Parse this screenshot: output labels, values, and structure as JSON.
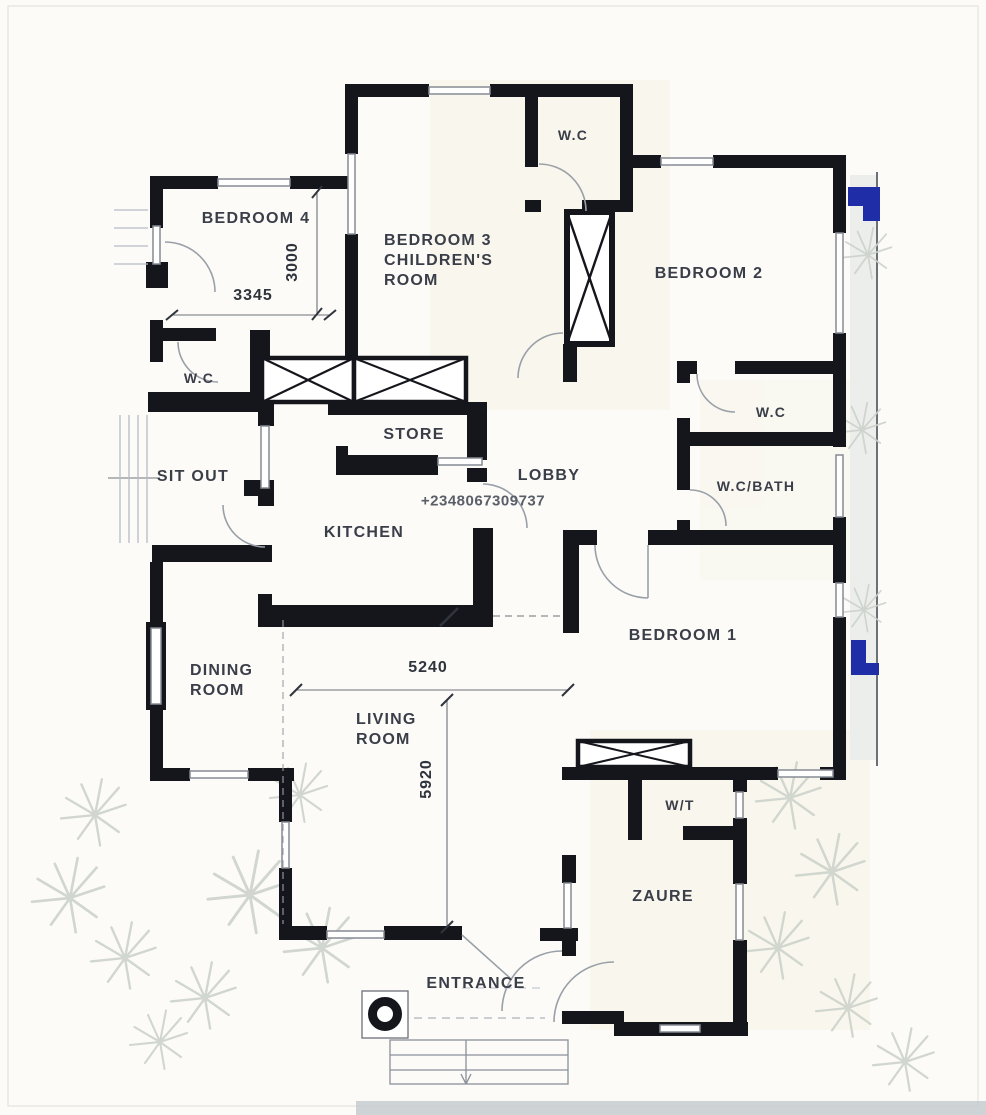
{
  "document": {
    "type": "residential-floor-plan",
    "background_color": "#fcfbf8"
  },
  "colors": {
    "wall": "#15151c",
    "thin_line": "#8a909a",
    "light_line": "#b6bcc4",
    "text": "#3a3e49",
    "accent_blue": "#1f2da6",
    "foliage": "#ccd2cb",
    "bottom_strip": "#c6cbcf"
  },
  "watermark": {
    "phone": "+2348067309737"
  },
  "rooms": {
    "bedroom4": {
      "label": "BEDROOM 4"
    },
    "bedroom3": {
      "line1": "BEDROOM 3",
      "line2": "CHILDREN'S",
      "line3": "ROOM"
    },
    "wc_top": {
      "label": "W.C"
    },
    "bedroom2": {
      "label": "BEDROOM 2"
    },
    "wc_left": {
      "label": "W.C"
    },
    "sit_out": {
      "label": "SIT OUT"
    },
    "store": {
      "label": "STORE"
    },
    "lobby": {
      "label": "LOBBY"
    },
    "kitchen": {
      "label": "KITCHEN"
    },
    "wc_right": {
      "label": "W.C"
    },
    "wc_bath": {
      "label": "W.C/BATH"
    },
    "bedroom1": {
      "label": "BEDROOM 1"
    },
    "dining": {
      "line1": "DINING",
      "line2": "ROOM"
    },
    "living": {
      "line1": "LIVING",
      "line2": "ROOM"
    },
    "wt": {
      "label": "W/T"
    },
    "zaure": {
      "label": "ZAURE"
    },
    "entrance": {
      "label": "ENTRANCE"
    }
  },
  "dimensions": {
    "bedroom4_width": "3345",
    "bedroom4_depth": "3000",
    "living_width": "5240",
    "living_depth": "5920"
  }
}
